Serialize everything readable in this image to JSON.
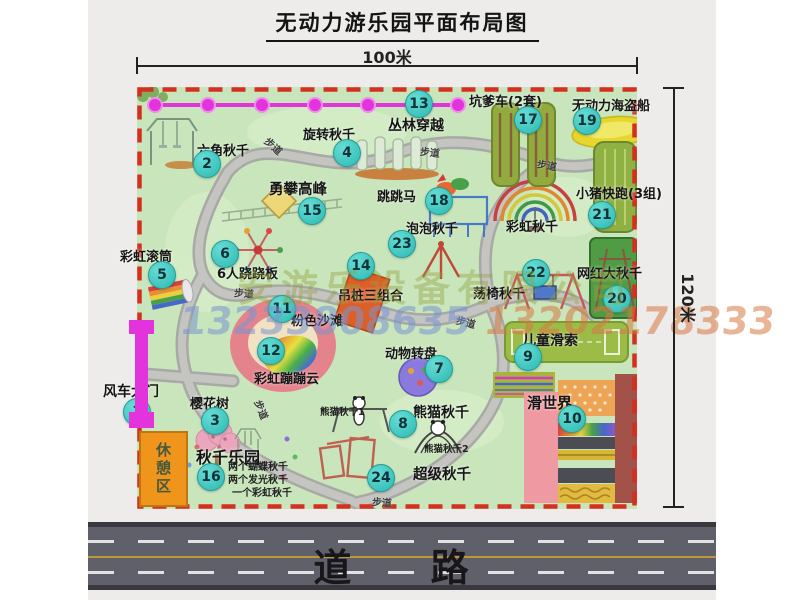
{
  "title": "无动力游乐园平面布局图",
  "dimensions": {
    "width": "100米",
    "height": "120米"
  },
  "road": {
    "label": "道 路"
  },
  "watermark": {
    "company": "安游乐设备有限公司",
    "phone_left": "13233808635",
    "phone_right": "13202178333"
  },
  "map": {
    "path_label": "步道",
    "rest_area_label": "休憩区",
    "attractions": [
      {
        "num": "1",
        "name": "风车大门"
      },
      {
        "num": "2",
        "name": "六角秋千"
      },
      {
        "num": "3",
        "name": "樱花树"
      },
      {
        "num": "4",
        "name": "旋转秋千"
      },
      {
        "num": "5",
        "name": "彩虹滚筒"
      },
      {
        "num": "6",
        "name": "6人跷跷板"
      },
      {
        "num": "7",
        "name": "动物转盘"
      },
      {
        "num": "8",
        "name": "熊猫秋千",
        "sub1": "熊猫秋千1",
        "sub2": "熊猫秋千2"
      },
      {
        "num": "9",
        "name": "儿童滑索"
      },
      {
        "num": "10",
        "name": "滑世界"
      },
      {
        "num": "11",
        "name": "粉色沙滩"
      },
      {
        "num": "12",
        "name": "彩虹蹦蹦云"
      },
      {
        "num": "13",
        "name": "丛林穿越"
      },
      {
        "num": "14",
        "name": "吊桩三组合"
      },
      {
        "num": "15",
        "name": "勇攀高峰"
      },
      {
        "num": "16",
        "name": "秋千乐园",
        "notes": [
          "两个蝴蝶秋千",
          "两个发光秋千",
          "一个彩虹秋千"
        ]
      },
      {
        "num": "17",
        "name": "坑爹车(2套)"
      },
      {
        "num": "18",
        "name": "跳跳马"
      },
      {
        "num": "19",
        "name": "无动力海盗船"
      },
      {
        "num": "20",
        "name": "网红大秋千"
      },
      {
        "num": "21",
        "name": "小猪快跑(3组)"
      },
      {
        "num": "22",
        "name": "荡椅秋千"
      },
      {
        "num": "23",
        "name": "泡泡秋千"
      },
      {
        "num": "24",
        "name": "超级秋千"
      },
      {
        "num": "",
        "name": "彩虹秋千"
      }
    ]
  }
}
